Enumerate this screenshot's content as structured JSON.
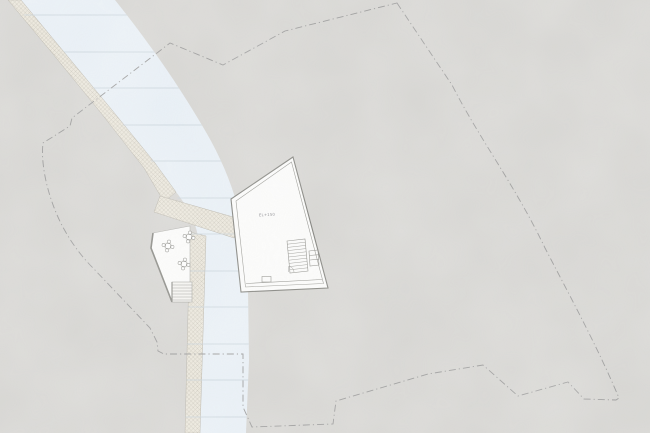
{
  "drawing": {
    "type": "architectural-site-plan",
    "building_label": "EL+150"
  },
  "colors": {
    "paper": "#d8d7d4",
    "water": "#eaf1f7",
    "water_line": "#c9d4dc",
    "bank": "#ece8dd",
    "bank_hatch": "#c9c5b9",
    "bank_edge": "#b9b5ab",
    "surface": "#fcfcfb",
    "wall_outer": "#84847f",
    "wall_inner": "#9a9a95",
    "detail": "#91918c",
    "boundary": "#9c9c9c",
    "label": "#85858a",
    "terrace_edge": "#8d8d88"
  }
}
